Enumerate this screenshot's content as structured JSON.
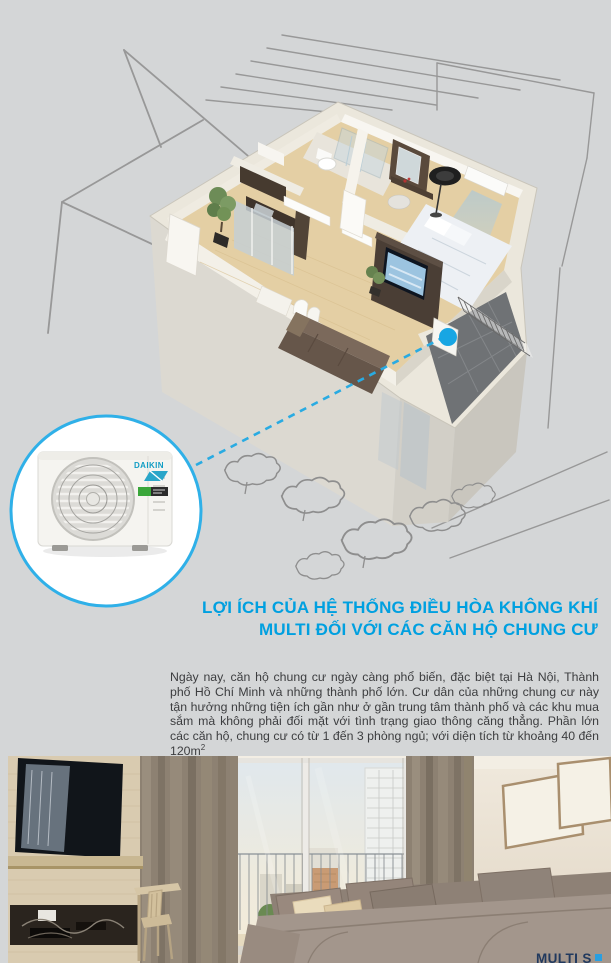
{
  "page": {
    "background_color": "#d4d6d7",
    "accent_blue": "#00a0e0",
    "connector_blue": "#29abe2"
  },
  "illustration": {
    "description": "3D cutaway of a one-bedroom apartment inside a sketched building outline, with a dashed callout to the outdoor air-conditioning unit on the balcony",
    "callout": {
      "unit_brand": "DAIKIN"
    }
  },
  "heading": {
    "line1": "LỢI ÍCH CỦA HỆ THỐNG ĐIỀU HÒA KHÔNG KHÍ",
    "line2": "MULTI ĐỐI VỚI CÁC CĂN HỘ CHUNG CƯ"
  },
  "body": {
    "text": "Ngày nay, căn hộ chung cư ngày càng phổ biến, đặc biệt tại Hà Nội, Thành phố Hồ Chí Minh và những thành phố lớn. Cư dân của những chung cư này tận hưởng những tiện ích gần như ở gần trung tâm thành phố và các khu mua sắm mà không phải đối mặt với tình trạng giao thông căng thẳng. Phần lớn các căn hộ, chung cư có từ 1 đến 3 phòng ngủ; với diện tích từ khoảng 40 đến 120m",
    "superscript": "2"
  },
  "photo": {
    "description": "Apartment living room with wooden TV panel, desk, curtains, city-view window and grey sofa",
    "brand_text": "MULTI S",
    "brand_mark_icon": "blue-square-mark"
  }
}
